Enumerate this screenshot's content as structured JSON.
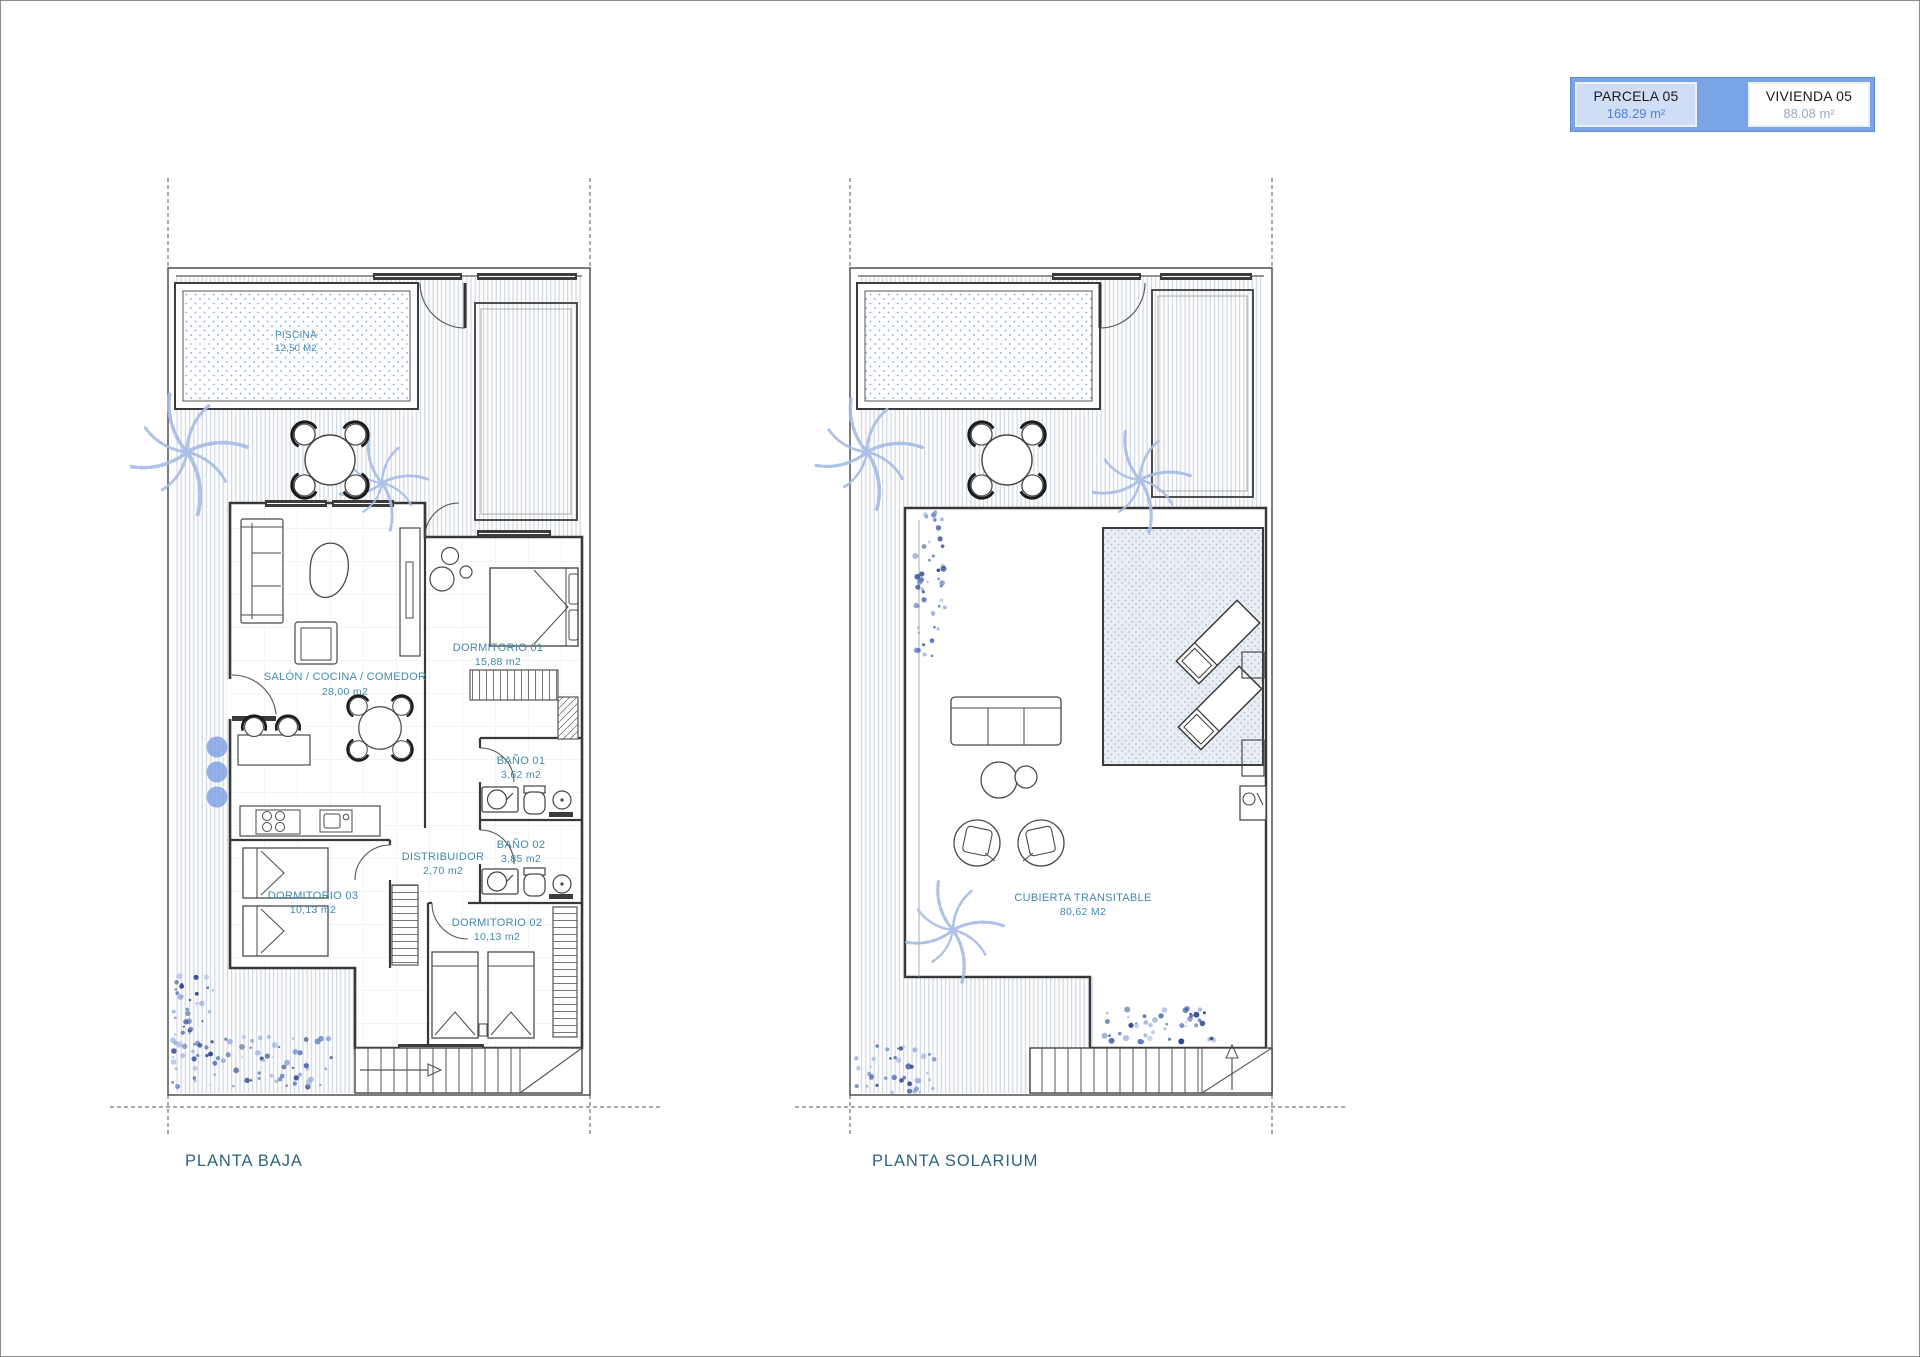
{
  "legend": {
    "parcela": {
      "label": "PARCELA 05",
      "value": "168.29 m²"
    },
    "vivienda": {
      "label": "VIVIENDA 05",
      "value": "88.08 m²"
    }
  },
  "plans": {
    "baja": {
      "title": "PLANTA BAJA",
      "rooms": {
        "piscina": {
          "name": "PISCINA",
          "area": "12,50 M2"
        },
        "salon": {
          "name": "SALÓN / COCINA / COMEDOR",
          "area": "28,00 m2"
        },
        "dormitorio01": {
          "name": "DORMITORIO 01",
          "area": "15,88 m2"
        },
        "bano01": {
          "name": "BAÑO 01",
          "area": "3,62 m2"
        },
        "bano02": {
          "name": "BAÑO 02",
          "area": "3,85 m2"
        },
        "distribuidor": {
          "name": "DISTRIBUIDOR",
          "area": "2,70 m2"
        },
        "dormitorio03": {
          "name": "DORMITORIO 03",
          "area": "10,13 m2"
        },
        "dormitorio02": {
          "name": "DORMITORIO 02",
          "area": "10,13 m2"
        }
      }
    },
    "solarium": {
      "title": "PLANTA SOLARIUM",
      "rooms": {
        "cubierta": {
          "name": "CUBIERTA TRANSITABLE",
          "area": "80,62 M2"
        }
      }
    }
  },
  "colors": {
    "legend_blue": "#7ba4e6",
    "legend_light": "#cfdef5",
    "value_blue": "#4d82d6",
    "label_teal": "#4389ab",
    "title_blue": "#2e647f",
    "plant_blue": "#a6bbe5"
  }
}
